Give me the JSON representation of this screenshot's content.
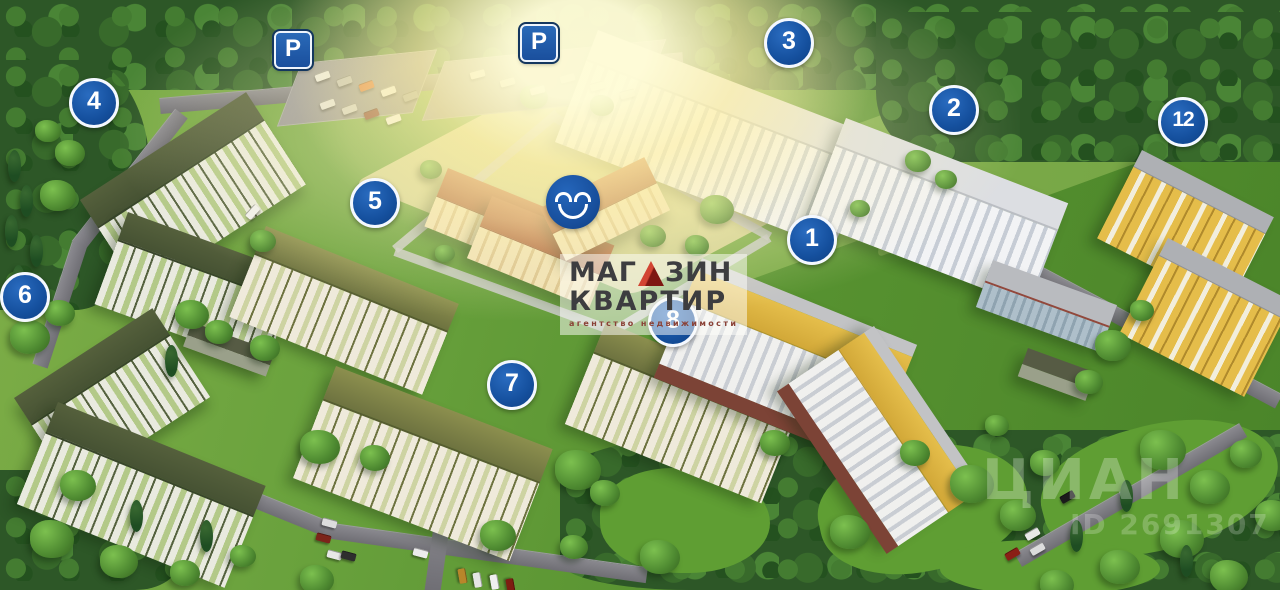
{
  "map": {
    "markers": [
      {
        "label": "1",
        "x": 812,
        "y": 240
      },
      {
        "label": "2",
        "x": 954,
        "y": 110
      },
      {
        "label": "3",
        "x": 789,
        "y": 43
      },
      {
        "label": "4",
        "x": 94,
        "y": 103
      },
      {
        "label": "5",
        "x": 375,
        "y": 203
      },
      {
        "label": "6",
        "x": 25,
        "y": 297
      },
      {
        "label": "7",
        "x": 512,
        "y": 385
      },
      {
        "label": "8",
        "x": 673,
        "y": 322
      },
      {
        "label": "12",
        "x": 1183,
        "y": 122
      }
    ],
    "parking_signs": [
      {
        "label": "P",
        "x": 293,
        "y": 50
      },
      {
        "label": "P",
        "x": 539,
        "y": 43
      }
    ],
    "smiley_marker": {
      "x": 573,
      "y": 202
    },
    "colors": {
      "marker_blue": "#15509e",
      "sign_blue": "#1a4f9d",
      "roof_green": "#4c5835",
      "roof_terracotta": "#b06038",
      "building_yellow": "#ddb23e",
      "grass_green": "#6aa23d",
      "road_gray": "#75747a"
    }
  },
  "agency_watermark": {
    "line1_pre": "МАГ",
    "line1_post": "ЗИН",
    "line2": "КВАРТИР",
    "tagline": "агентство недвижимости"
  },
  "photo_watermark": {
    "brand": "ЦИАН",
    "id_label": "ID 2691307"
  }
}
